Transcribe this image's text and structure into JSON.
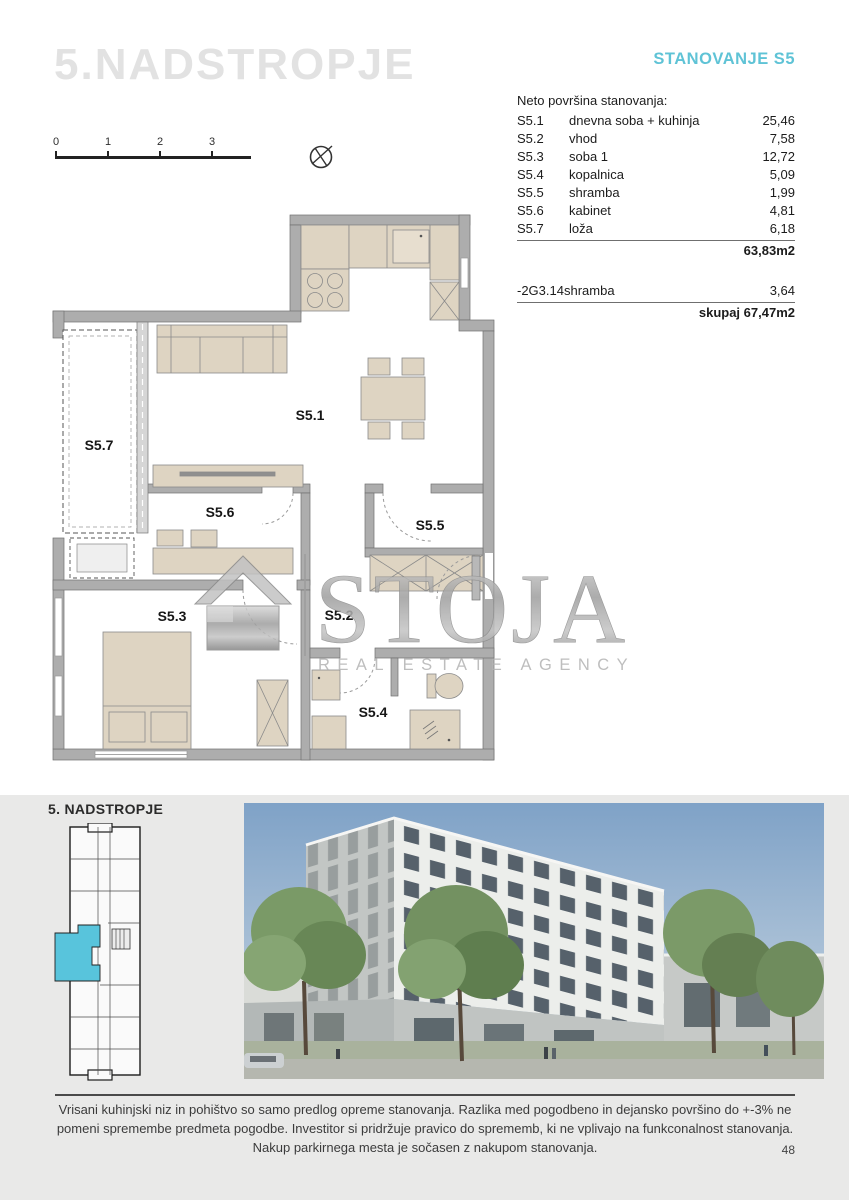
{
  "header": {
    "floor_title": "5.NADSTROPJE",
    "apartment_title": "STANOVANJE S5",
    "accent_color": "#5fc3d6"
  },
  "scalebar": {
    "ticks": [
      "0",
      "1",
      "2",
      "3"
    ]
  },
  "area_table": {
    "heading": "Neto površina stanovanja:",
    "rows": [
      {
        "code": "S5.1",
        "name": "dnevna soba + kuhinja",
        "area": "25,46"
      },
      {
        "code": "S5.2",
        "name": "vhod",
        "area": "7,58"
      },
      {
        "code": "S5.3",
        "name": "soba 1",
        "area": "12,72"
      },
      {
        "code": "S5.4",
        "name": "kopalnica",
        "area": "5,09"
      },
      {
        "code": "S5.5",
        "name": "shramba",
        "area": "1,99"
      },
      {
        "code": "S5.6",
        "name": "kabinet",
        "area": "4,81"
      },
      {
        "code": "S5.7",
        "name": "loža",
        "area": "6,18"
      }
    ],
    "subtotal": "63,83m2",
    "deduction": {
      "code": "-2G3.14",
      "name": "shramba",
      "area": "3,64"
    },
    "total_label": "skupaj",
    "total_value": "67,47m2"
  },
  "floorplan": {
    "labels": {
      "s51": "S5.1",
      "s52": "S5.2",
      "s53": "S5.3",
      "s54": "S5.4",
      "s55": "S5.5",
      "s56": "S5.6",
      "s57": "S5.7"
    }
  },
  "watermark": {
    "name": "STOJA",
    "tagline": "REAL ESTATE AGENCY"
  },
  "keyplan": {
    "title": "5. NADSTROPJE",
    "highlight_color": "#58c4dc"
  },
  "footer": {
    "disclaimer": "Vrisani kuhinjski niz in pohištvo so samo predlog opreme stanovanja. Razlika med pogodbeno in dejansko površino do +-3% ne pomeni spremembe predmeta pogodbe. Investitor si pridržuje pravico do sprememb, ki ne vplivajo na funkconalnost stanovanja. Nakup parkirnega mesta je sočasen z nakupom stanovanja.",
    "page_number": "48"
  }
}
